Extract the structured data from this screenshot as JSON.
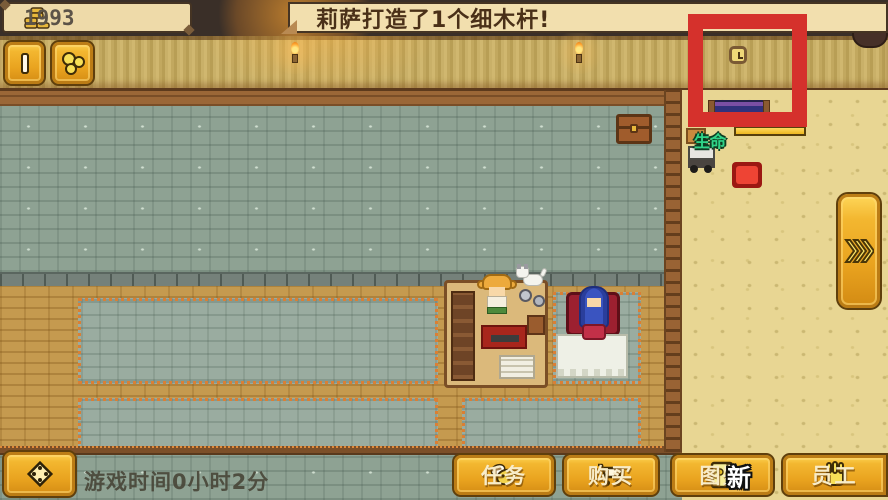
{
  "colors": {
    "gold_button": "#f2b42e",
    "annotation_red": "#d5312c",
    "health_label_green": "#2fd488",
    "health_bar_fill": "#ecb821"
  },
  "hud": {
    "money": {
      "value": "1993",
      "icon": "coin-stack-icon"
    },
    "banner": {
      "text": "莉萨打造了1个细木杆!"
    },
    "pause_button": {
      "icon": "pause-icon"
    },
    "craft_button": {
      "icon": "gold-nuggets-icon"
    },
    "fast_forward_button": {
      "icon": "triple-chevron-icon"
    },
    "move_button": {
      "icon": "diamond-dots-icon"
    },
    "game_time": "游戏时间0小时2分",
    "health": {
      "label": "生命",
      "fill_pct": 100
    },
    "menu_buttons": [
      {
        "id": "tasks",
        "label": "任务",
        "icon": "bee-icon"
      },
      {
        "id": "buy",
        "label": "购买",
        "icon": "cart-icon"
      },
      {
        "id": "catalog",
        "label": "图鉴",
        "icon": "book-icon",
        "badge": "新"
      },
      {
        "id": "staff",
        "label": "员工",
        "icon": "glove-icon"
      }
    ]
  },
  "scene": {
    "annotation": {
      "shape": "rectangle",
      "color": "#d5312c",
      "highlights": "wall-clock"
    },
    "objects": [
      "wall-clock",
      "wall-torch-left",
      "wall-torch-right",
      "bed",
      "treasure-chest",
      "crafting-station",
      "crafter-npc",
      "customer-npc",
      "chair",
      "dining-table",
      "dog",
      "red-item",
      "supply-cart",
      "crate",
      "ladder-divider"
    ]
  }
}
